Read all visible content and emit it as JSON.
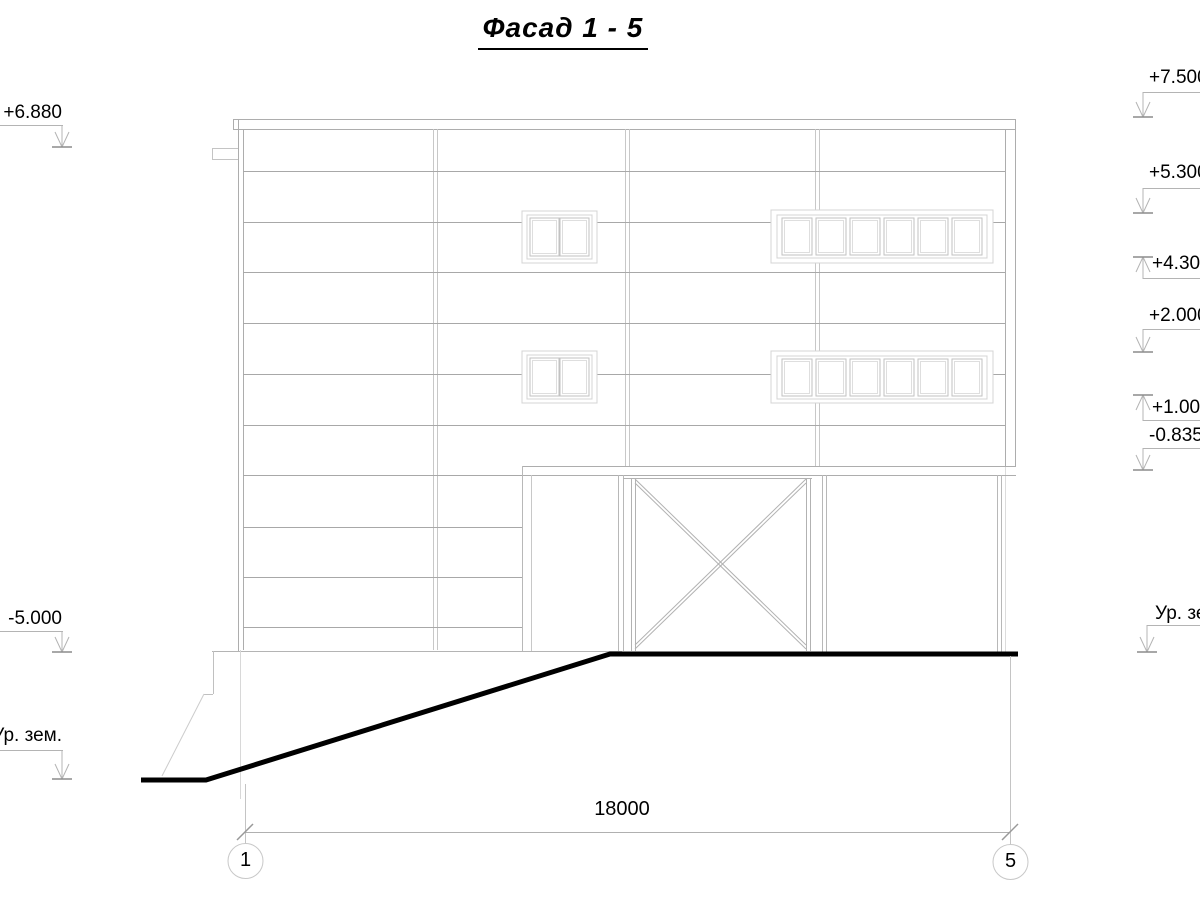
{
  "title": "Фасад 1 - 5",
  "levels": {
    "left": [
      {
        "label": "+6.880"
      },
      {
        "label": "-5.000"
      },
      {
        "label": "Ур. зем."
      }
    ],
    "right": [
      {
        "label": "+7.500"
      },
      {
        "label": "+5.300"
      },
      {
        "label": "+4.300"
      },
      {
        "label": "+2.000"
      },
      {
        "label": "+1.000"
      },
      {
        "label": "-0.835"
      },
      {
        "label": "Ур. зем."
      }
    ]
  },
  "dimension": {
    "length": "18000"
  },
  "axes": {
    "first": "1",
    "last": "5"
  },
  "colors": {
    "ink": "#000000",
    "outline_gray": "#a9a9a9",
    "light_gray": "#c8c8c8",
    "frame_gray": "#d4d4d4"
  }
}
